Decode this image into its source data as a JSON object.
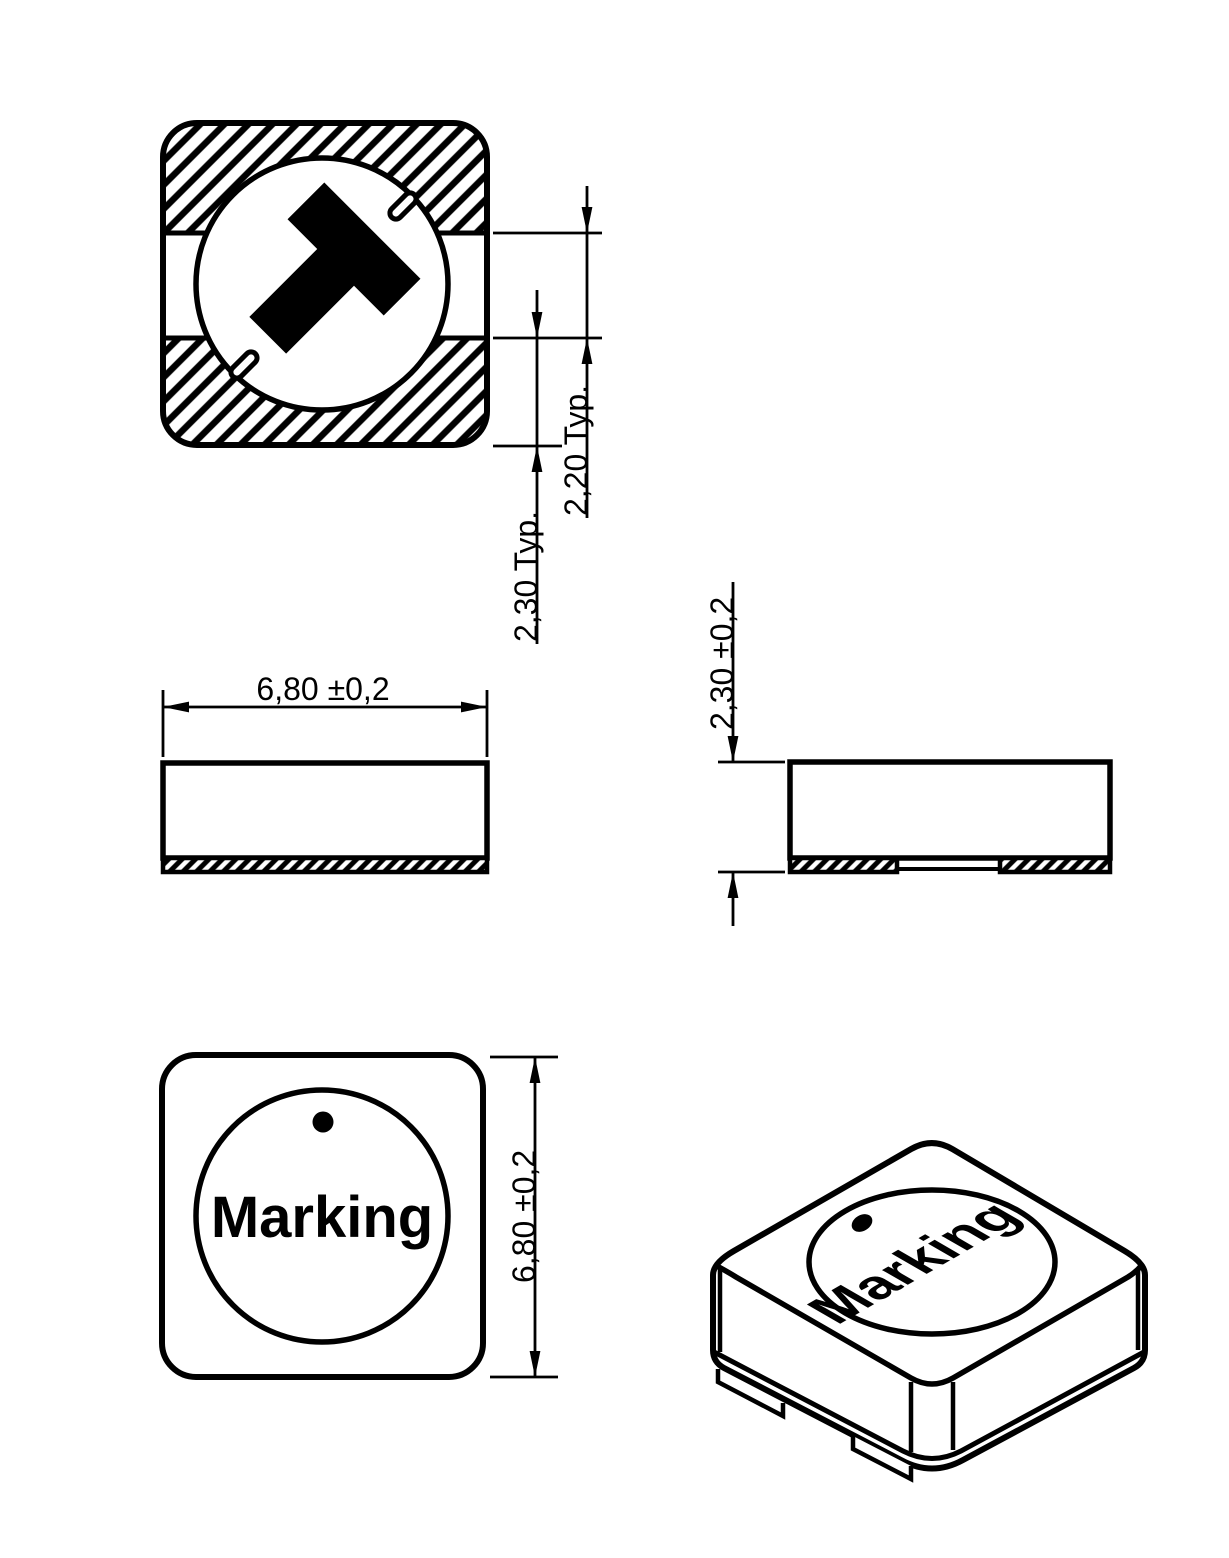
{
  "drawing": {
    "type": "technical-dimension-drawing",
    "component": "SMD shielded power inductor, 4 views (bottom, front, side, top, isometric)",
    "dimensions": {
      "pad_gap": "2,20 Typ.",
      "pad_height": "2,30 Typ.",
      "body_width": "6,80 ±0,2",
      "body_height": "2,30 ±0,2",
      "body_depth": "6,80 ±0,2"
    },
    "labels": {
      "marking_top": "Marking",
      "marking_iso": "Marking"
    },
    "colors": {
      "line": "#000000",
      "background": "#ffffff"
    }
  }
}
